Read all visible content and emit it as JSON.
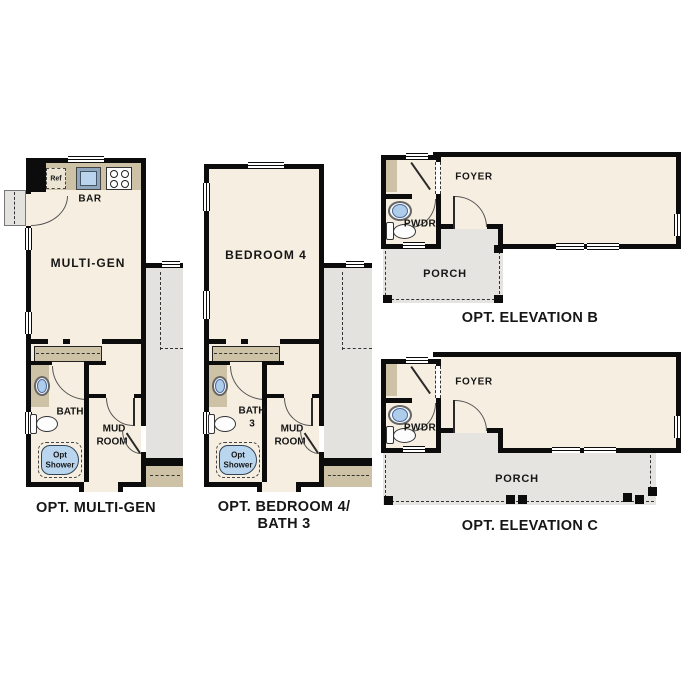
{
  "sheet": {
    "background": "#ffffff"
  },
  "colors": {
    "wall": "#0c0c0c",
    "room_fill": "#f6efe1",
    "counter_tan": "#cdc1a6",
    "side_gray": "#e3e2df",
    "porch_gray": "#e5e4e1",
    "sink_blue": "#aecdea",
    "shower_blue": "#bad6ee"
  },
  "multigen": {
    "caption": "OPT. MULTI-GEN",
    "room": "MULTI-GEN",
    "bar": "BAR",
    "ref": "Ref",
    "bath": "BATH",
    "mud_line1": "MUD",
    "mud_line2": "ROOM",
    "shower_line1": "Opt",
    "shower_line2": "Shower"
  },
  "bedroom4": {
    "caption_line1": "OPT. BEDROOM 4/",
    "caption_line2": "BATH 3",
    "room": "BEDROOM 4",
    "bath_line1": "BATH",
    "bath_line2": "3",
    "mud_line1": "MUD",
    "mud_line2": "ROOM",
    "shower_line1": "Opt",
    "shower_line2": "Shower"
  },
  "elevation_b": {
    "caption": "OPT. ELEVATION B",
    "foyer": "FOYER",
    "pwdr": "PWDR",
    "porch": "PORCH"
  },
  "elevation_c": {
    "caption": "OPT. ELEVATION C",
    "foyer": "FOYER",
    "pwdr": "PWDR",
    "porch": "PORCH"
  }
}
